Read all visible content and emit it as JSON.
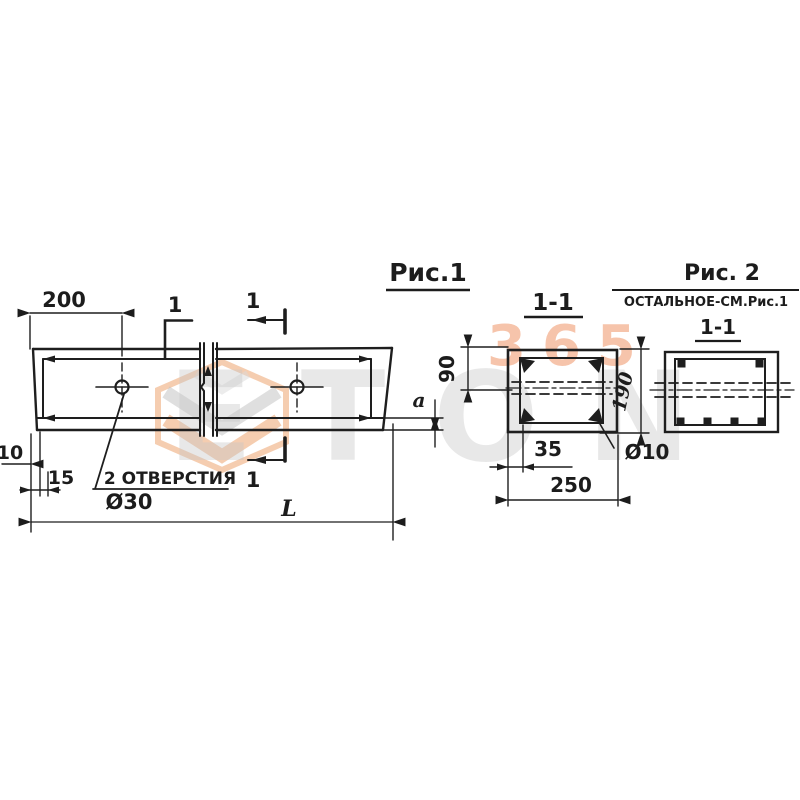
{
  "watermark": {
    "number": "365",
    "brand": "ETON",
    "orange": "#eda470",
    "grey": "#c7c7c7"
  },
  "figure1": {
    "title": "Рис.1",
    "section_mark_top_left": "1",
    "section_mark_top_right": "1",
    "section_mark_bottom": "1",
    "dim_left_to_hole": "200",
    "dim_edge_offset": "10",
    "dim_bottom_inset": "15",
    "holes_note": "2 ОТВЕРСТИЯ",
    "holes_diameter": "Ø30",
    "length_label": "L",
    "gap_label": "a"
  },
  "section_1_1": {
    "title": "1-1",
    "dim_top_to_hole": "90",
    "dim_height": "190",
    "dim_cover": "35",
    "dim_width": "250",
    "rebar_diameter": "Ø10"
  },
  "figure2": {
    "title": "Рис. 2",
    "note": "ОСТАЛЬНОЕ-СМ.Рис.1",
    "section_title": "1-1"
  },
  "colors": {
    "ink": "#1c1c1c",
    "background": "#ffffff"
  }
}
